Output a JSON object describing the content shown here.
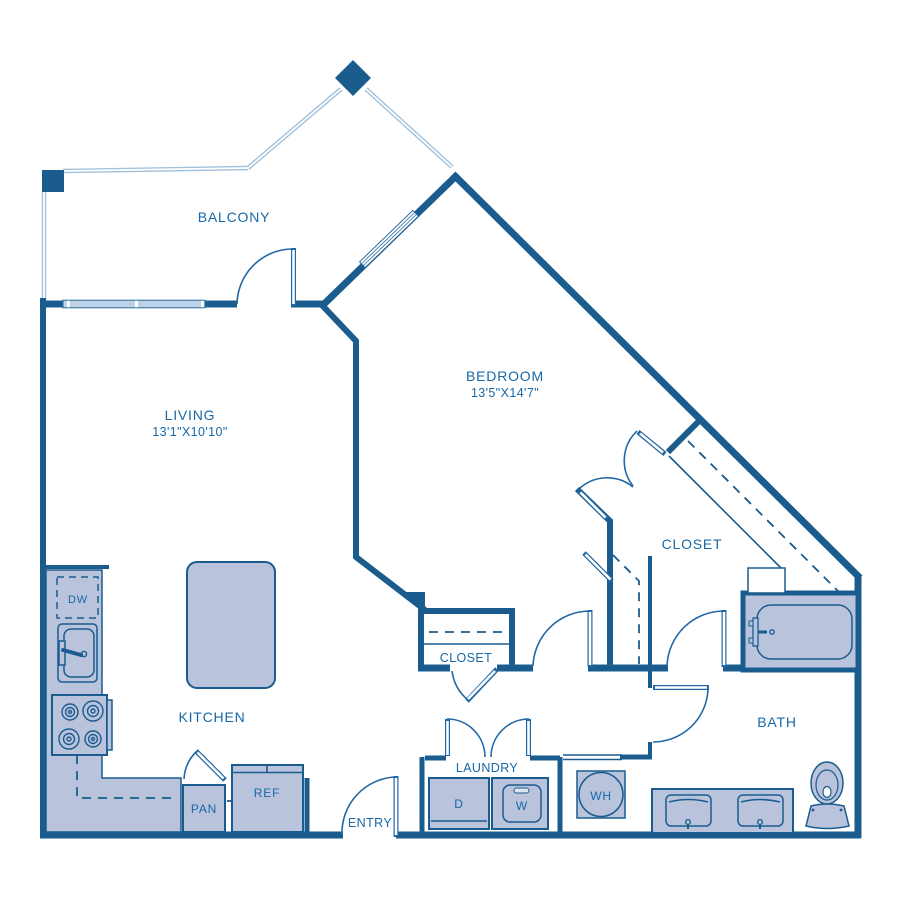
{
  "plan": {
    "type": "apartment-floor-plan",
    "colors": {
      "wall": "#1b5c8f",
      "line": "#2368a6",
      "text": "#1668a8",
      "fill": "#b9c3dc",
      "railing": "#9fc0dc"
    },
    "rooms": {
      "balcony": {
        "label": "BALCONY"
      },
      "living": {
        "label": "LIVING",
        "dims": "13'1\"X10'10\""
      },
      "bedroom": {
        "label": "BEDROOM",
        "dims": "13'5\"X14'7\""
      },
      "closet_bedroom": {
        "label": "CLOSET"
      },
      "closet_hall": {
        "label": "CLOSET"
      },
      "kitchen": {
        "label": "KITCHEN"
      },
      "bath": {
        "label": "BATH"
      },
      "laundry": {
        "label": "LAUNDRY"
      },
      "entry": {
        "label": "ENTRY"
      }
    },
    "fixtures": {
      "pantry": "PAN",
      "refrigerator": "REF",
      "dishwasher": "DW",
      "dryer": "D",
      "washer": "W",
      "water_heater": "WH"
    }
  }
}
